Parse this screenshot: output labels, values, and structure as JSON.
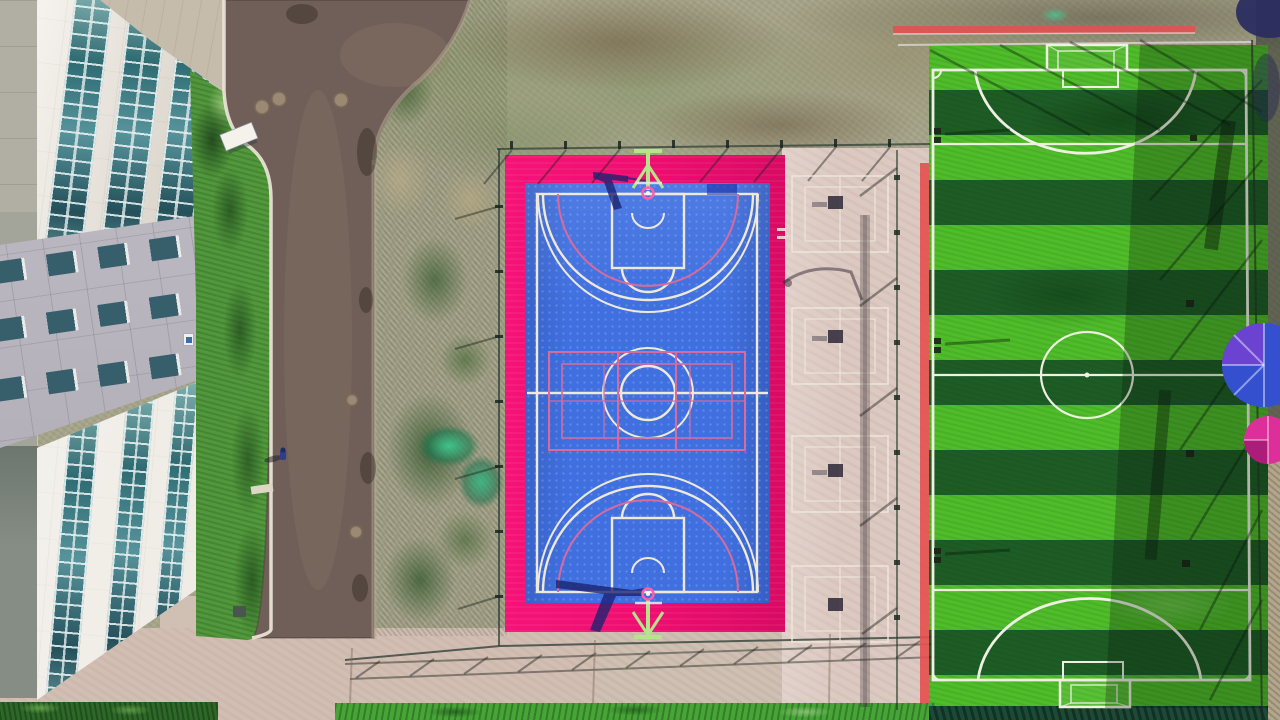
{
  "scene": {
    "type": "aerial-drone-photograph",
    "description": "Top-down aerial view of a campus sports area: a white office building with glass curtain-wall strips on the left, a dark asphalt road, a scrub grass strip, a blue basketball court with a magenta-pink apron and light-green hoop stands, a pale concrete zone with badminton court markings and benches, and a striped artificial-turf football pitch with white markings, goals, perimeter fencing, red edge strips and blue/pink umbrellas at the right edge; concrete paving and hedges run along the bottom.",
    "objects": [
      "office-building",
      "glass-curtain-wall",
      "gray-facade-band",
      "asphalt-road",
      "manholes",
      "pedestrian",
      "lawn-strip",
      "white-canopy",
      "scrub-ground",
      "construction-netting",
      "basketball-court",
      "pink-apron",
      "basketball-hoops",
      "volleyball-overlay-lines",
      "badminton-courts",
      "benches",
      "street-lamp-shadow",
      "perimeter-fence",
      "football-pitch",
      "mowing-stripes",
      "goals",
      "center-circle",
      "red-track-strips",
      "umbrellas",
      "hedges",
      "concrete-paving"
    ],
    "counts": {
      "badminton_courts": 4,
      "basketball_hoops": 2,
      "football_goals": 2,
      "umbrellas": 2,
      "manholes": 5
    }
  },
  "colors": {
    "scrub_base": "#a6a48a",
    "road": "#6f5f58",
    "plaza": "#c6bcab",
    "pavement": "#cfc0b3",
    "concrete_mid": "#dcc9c1",
    "building_white": "#ece7de",
    "gray_band": "#b6b2bc",
    "band_window": "#375f6b",
    "slab_light": "#b1aea4",
    "slab_mid": "#a3a59b",
    "slab_dark": "#868d85",
    "grass_strip": "#47a436",
    "hedge": "#2e6828",
    "pink": "#ef0e70",
    "pink_deep": "#d90a64",
    "court_blue": "#4070e0",
    "line_white": "#efe9da",
    "line_pink": "#d96a9b",
    "hoop_green": "#b5e48c",
    "hoop_ring": "#ff5fa8",
    "shadow_navy": "#1c2370",
    "field_green": "#4fbc2a",
    "field_green_dark": "#1e5c26",
    "field_line": "#eef0e2",
    "red_strip": "#e64f4f",
    "fence_dark": "#2a3a33",
    "dirt": "#b3a68d",
    "umbrella_blue": "#3550cf",
    "umbrella_purple": "#7a3fd0",
    "umbrella_pink": "#dd2f9a",
    "person": "#2c3e8c"
  }
}
